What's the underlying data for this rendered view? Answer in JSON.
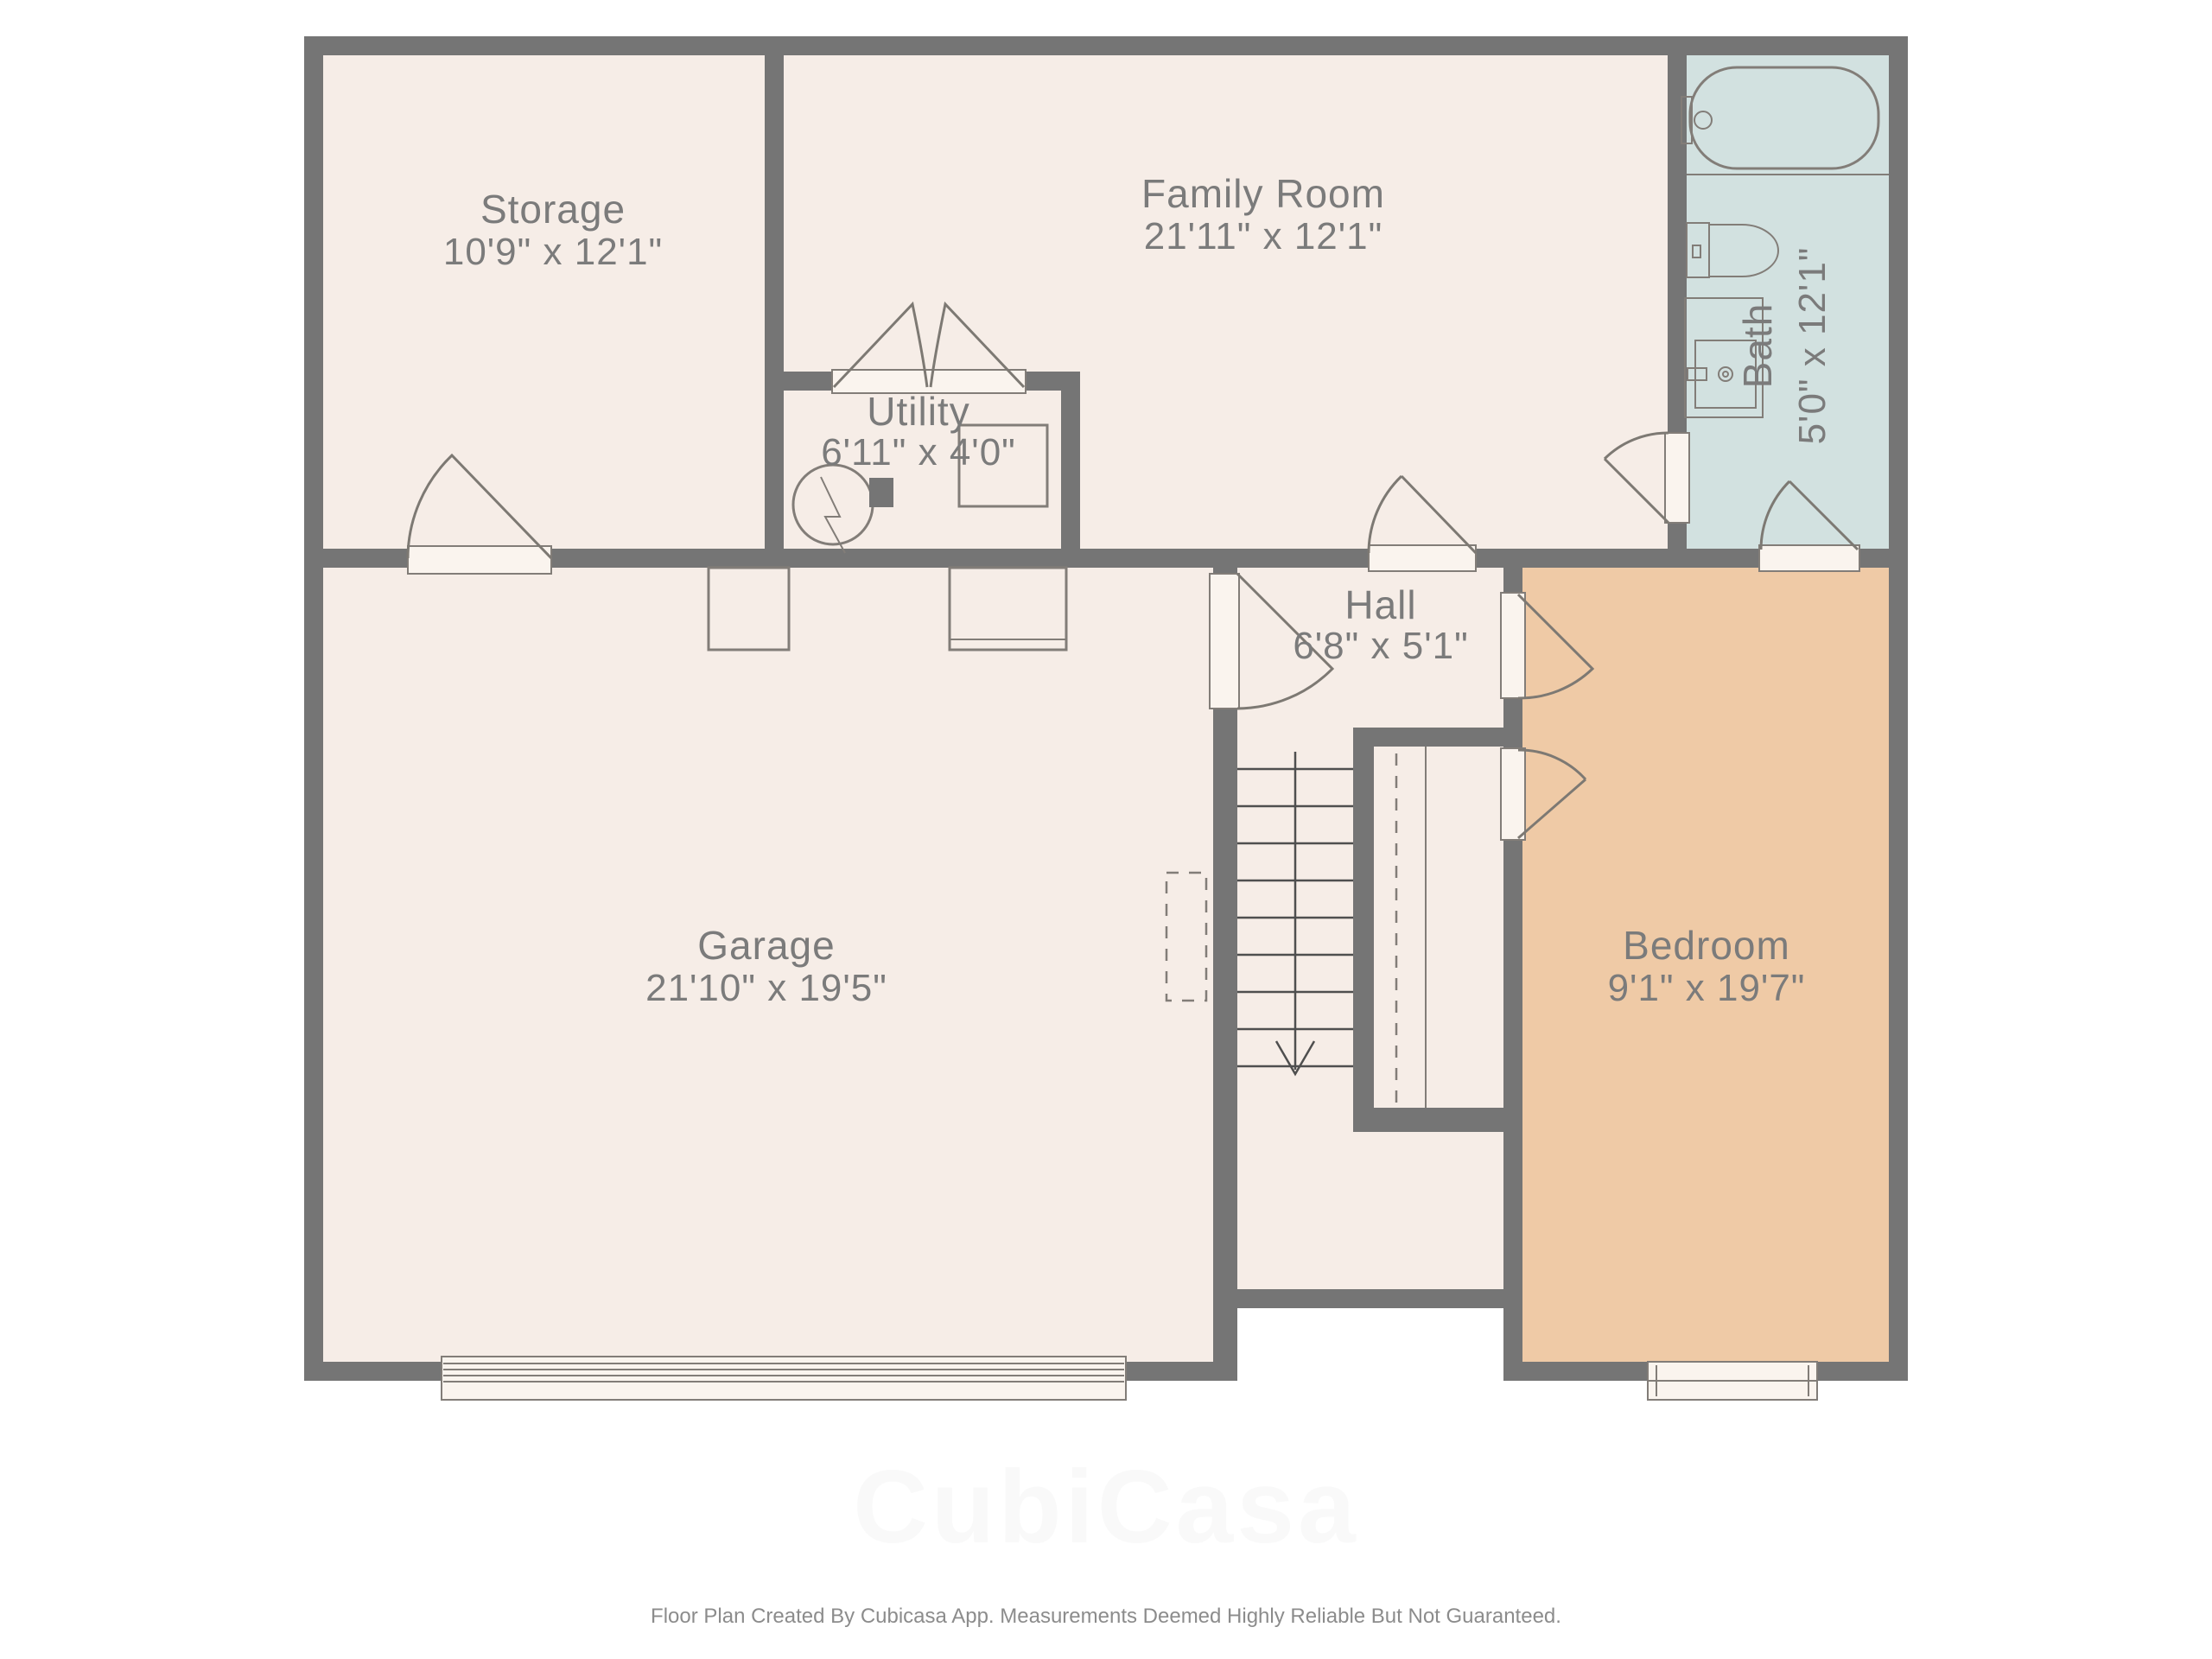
{
  "rooms": {
    "storage": {
      "name": "Storage",
      "dims": "10'9\" x 12'1\""
    },
    "family_room": {
      "name": "Family Room",
      "dims": "21'11\" x 12'1\""
    },
    "utility": {
      "name": "Utility",
      "dims": "6'11\" x 4'0\""
    },
    "bath": {
      "name": "Bath",
      "dims": "5'0\" x 12'1\""
    },
    "hall": {
      "name": "Hall",
      "dims": "6'8\" x 5'1\""
    },
    "garage": {
      "name": "Garage",
      "dims": "21'10\" x 19'5\""
    },
    "bedroom": {
      "name": "Bedroom",
      "dims": "9'1\" x 19'7\""
    }
  },
  "footer": {
    "text": "Floor Plan Created By Cubicasa App. Measurements Deemed Highly Reliable But Not Guaranteed."
  },
  "watermark": {
    "text": "CubiCasa"
  },
  "colors": {
    "wall": "#757575",
    "floor": "#f6ede7",
    "bath": "#d2e1e0",
    "bedroom": "#efcaa6",
    "line": "#827d78",
    "door": "#7d7973",
    "stair": "#4f4f4f",
    "text": "#7b7b7b",
    "threshold": "#faf4ee",
    "footer": "#8c8c8c",
    "white": "#ffffff"
  }
}
